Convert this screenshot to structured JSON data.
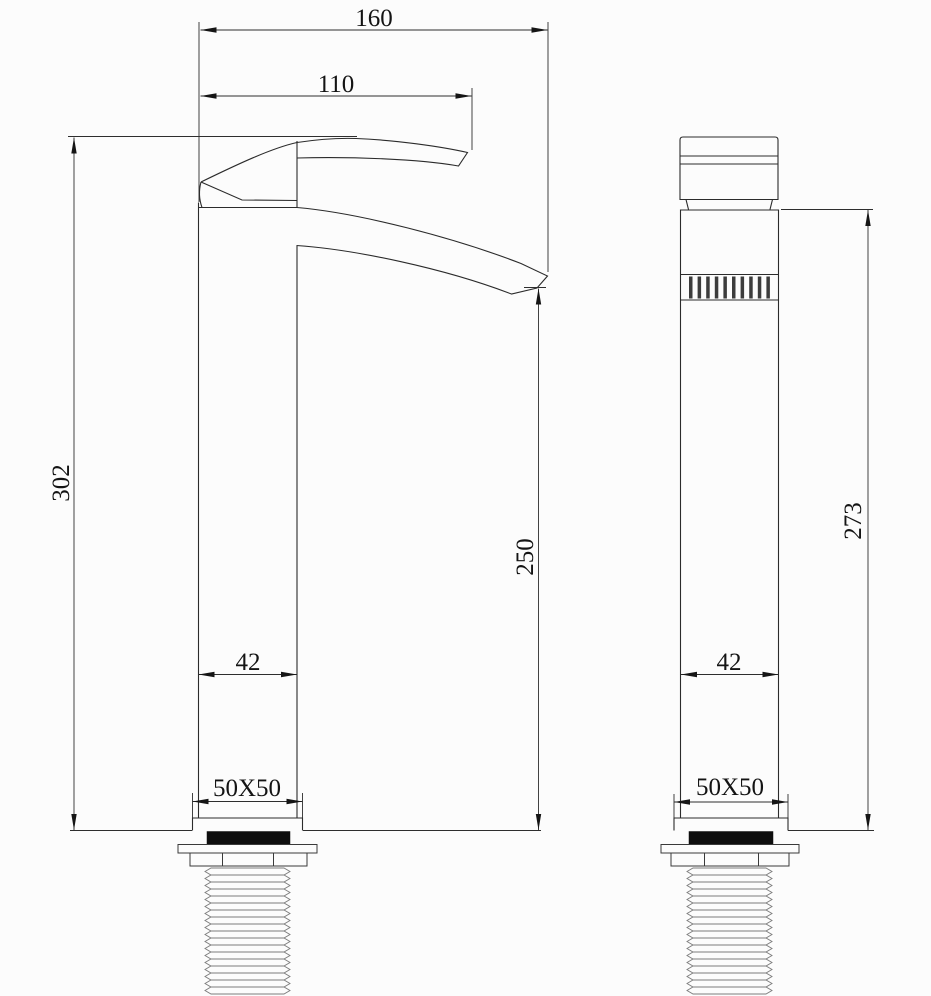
{
  "drawing": {
    "dimensions": {
      "front": {
        "overall_width": "160",
        "spout_reach": "110",
        "overall_height": "302",
        "spout_height": "250",
        "body_width": "42",
        "base_size": "50X50"
      },
      "side": {
        "body_height": "273",
        "body_width": "42",
        "base_size": "50X50"
      }
    }
  }
}
